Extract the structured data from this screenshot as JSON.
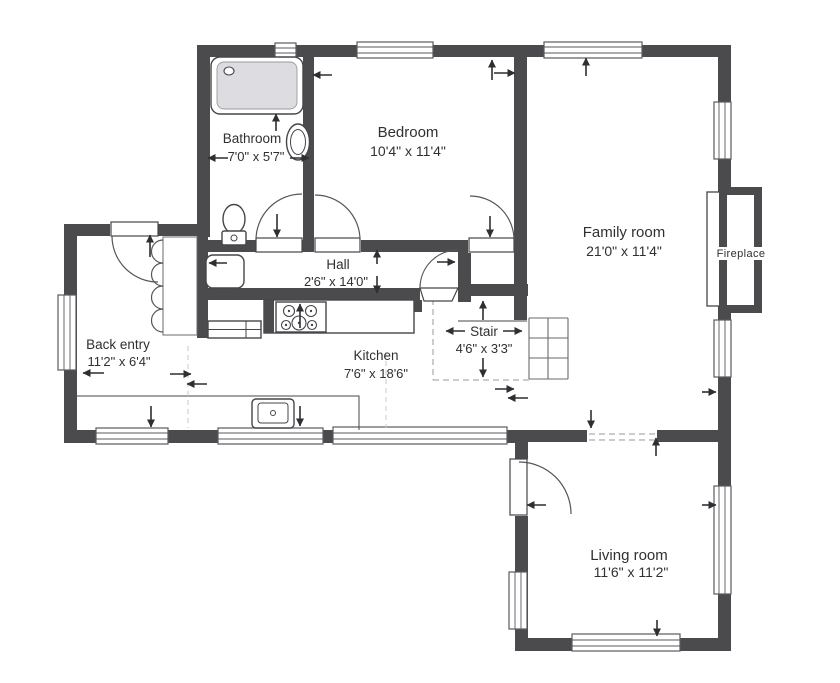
{
  "meta": {
    "type": "floor-plan"
  },
  "colors": {
    "wall": "#4b4b4e",
    "line": "#46464a",
    "text": "#303034",
    "tub_fill": "#dddde1"
  },
  "rooms": {
    "bathroom": {
      "name": "Bathroom",
      "dims": "7'0\" x 5'7\""
    },
    "bedroom": {
      "name": "Bedroom",
      "dims": "10'4\" x 11'4\""
    },
    "family_room": {
      "name": "Family room",
      "dims": "21'0\" x 11'4\""
    },
    "hall": {
      "name": "Hall",
      "dims": "2'6\" x 14'0\""
    },
    "back_entry": {
      "name": "Back entry",
      "dims": "11'2\" x 6'4\""
    },
    "stair": {
      "name": "Stair",
      "dims": "4'6\" x 3'3\""
    },
    "kitchen": {
      "name": "Kitchen",
      "dims": "7'6\" x 18'6\""
    },
    "living_room": {
      "name": "Living room",
      "dims": "11'6\" x 11'2\""
    }
  },
  "labels": {
    "fireplace": "Fireplace"
  }
}
